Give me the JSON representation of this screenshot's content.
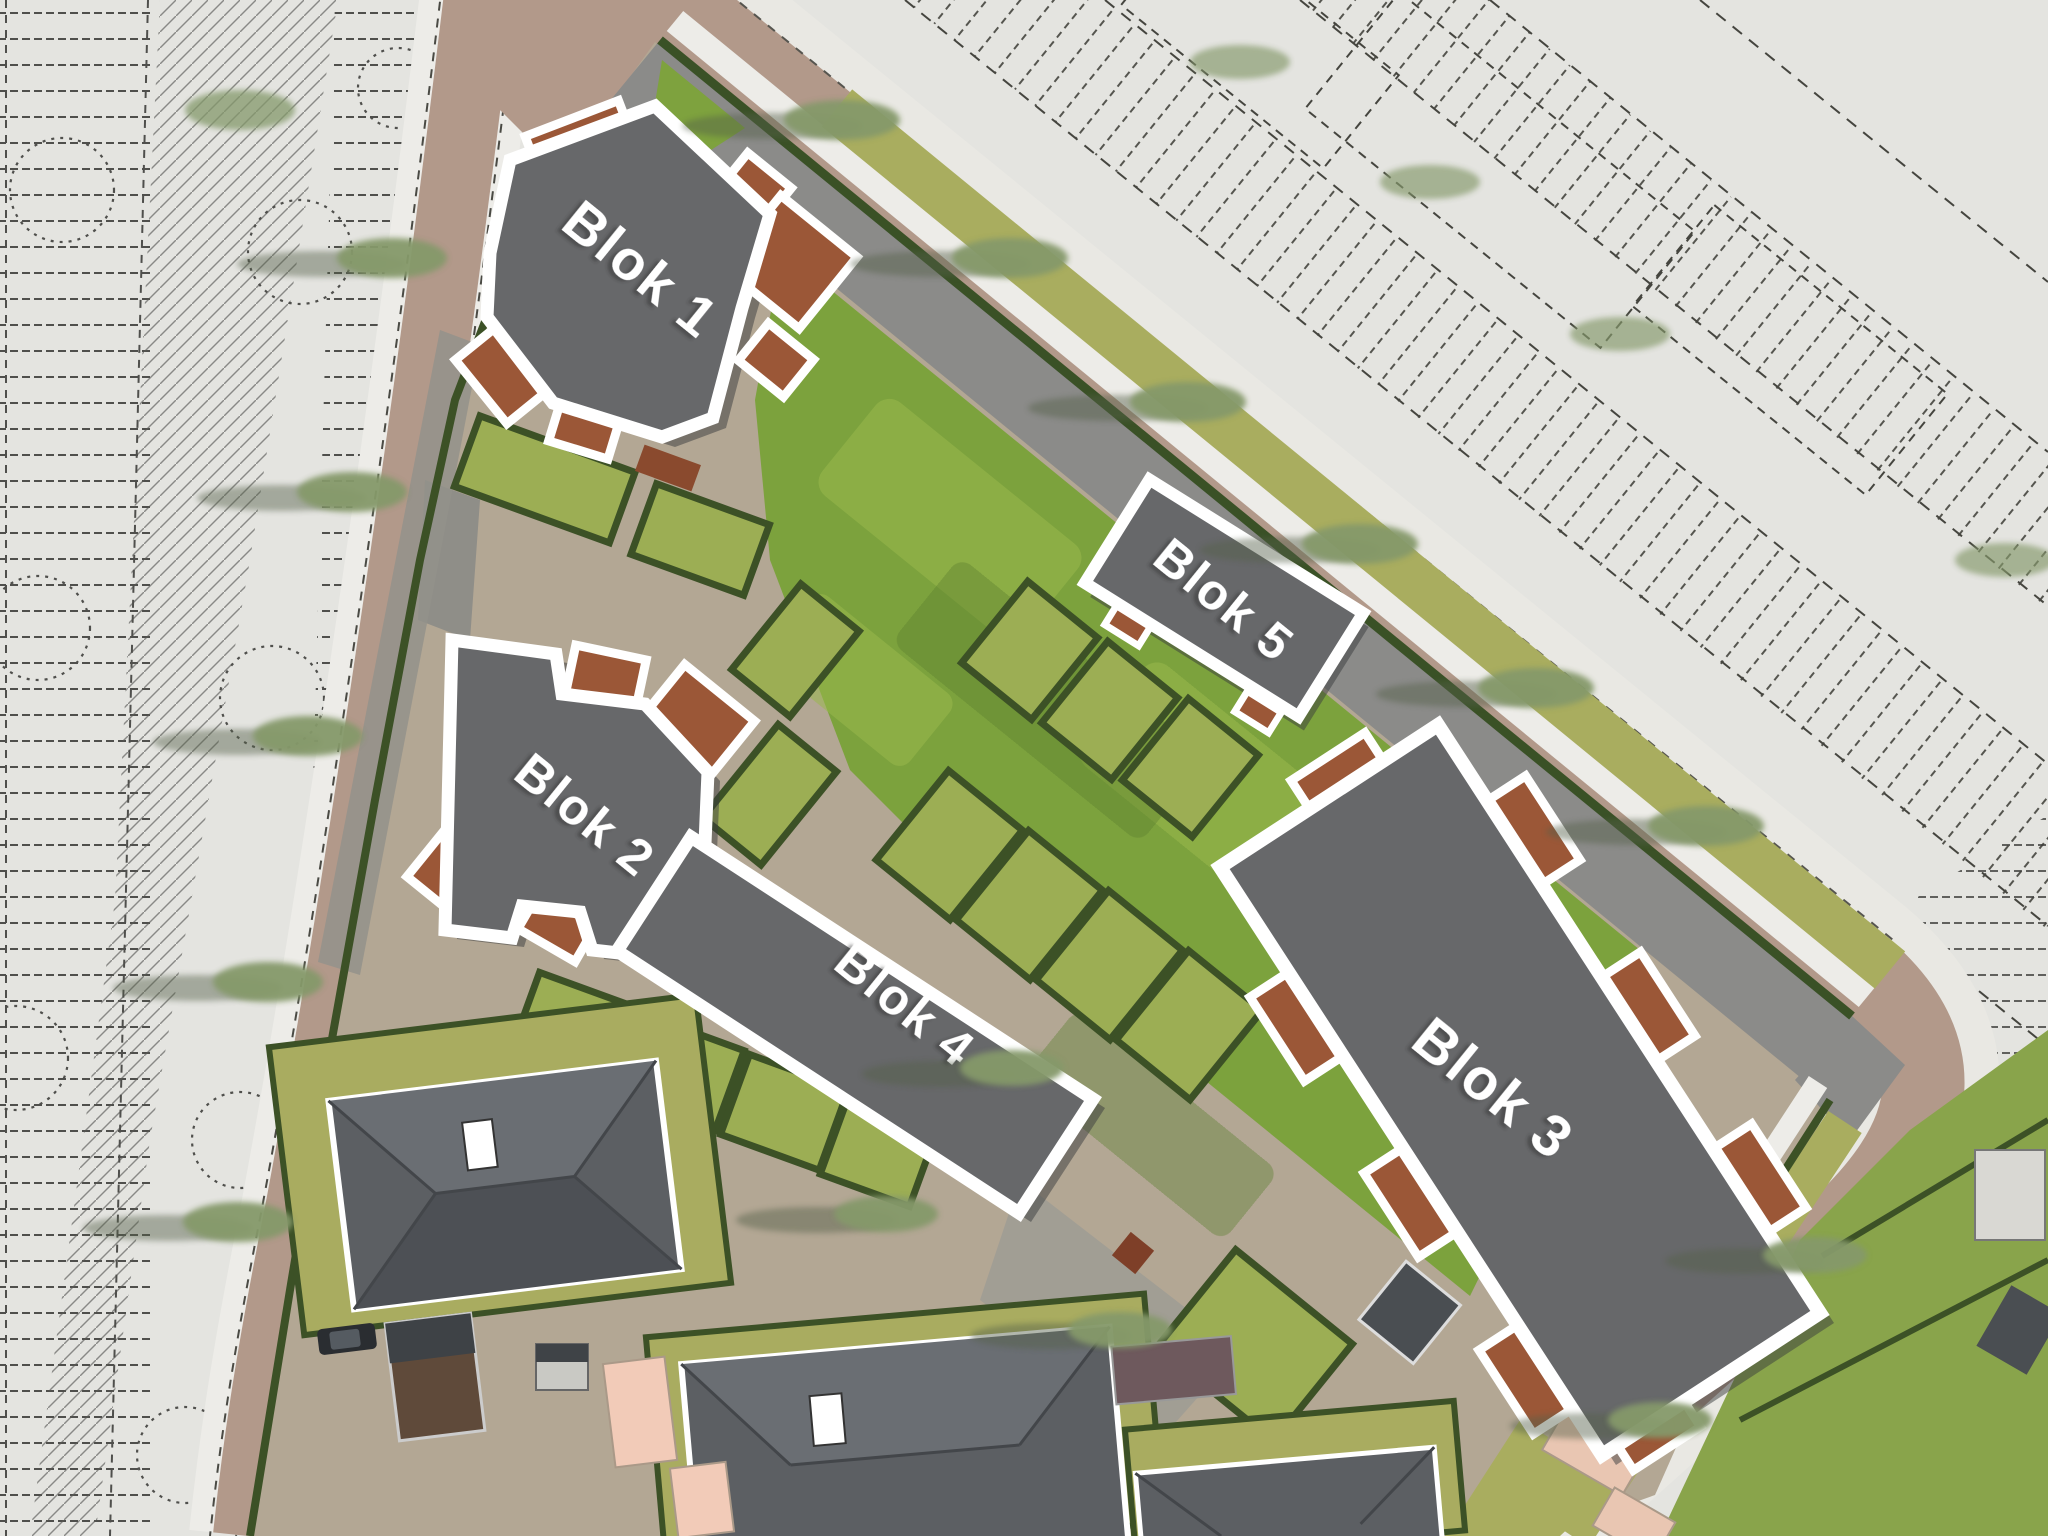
{
  "plan": {
    "type": "residential-site-plan",
    "blocks": [
      {
        "id": "blok-1",
        "label": "Blok 1"
      },
      {
        "id": "blok-2",
        "label": "Blok 2"
      },
      {
        "id": "blok-3",
        "label": "Blok 3"
      },
      {
        "id": "blok-4",
        "label": "Blok 4"
      },
      {
        "id": "blok-5",
        "label": "Blok 5"
      }
    ]
  },
  "colors": {
    "cad_background": "#e4e4e0",
    "cad_line": "#3f3f3c",
    "road_brick": "#b2998a",
    "sidewalk": "#edece8",
    "hedge": "#3c5126",
    "verge_olive": "#a9ad5f",
    "lawn_green": "#7ca23d",
    "lawn_light": "#9ab94e",
    "plot_green": "#9cae54",
    "building_gray": "#67686a",
    "building_outline": "#ffffff",
    "balcony_brown": "#9b5737",
    "roof_gray": "#5c5f63",
    "patio_pink": "#f2cbb8",
    "ground_tan": "#b3a794",
    "paving_gray": "#8b8b89"
  }
}
